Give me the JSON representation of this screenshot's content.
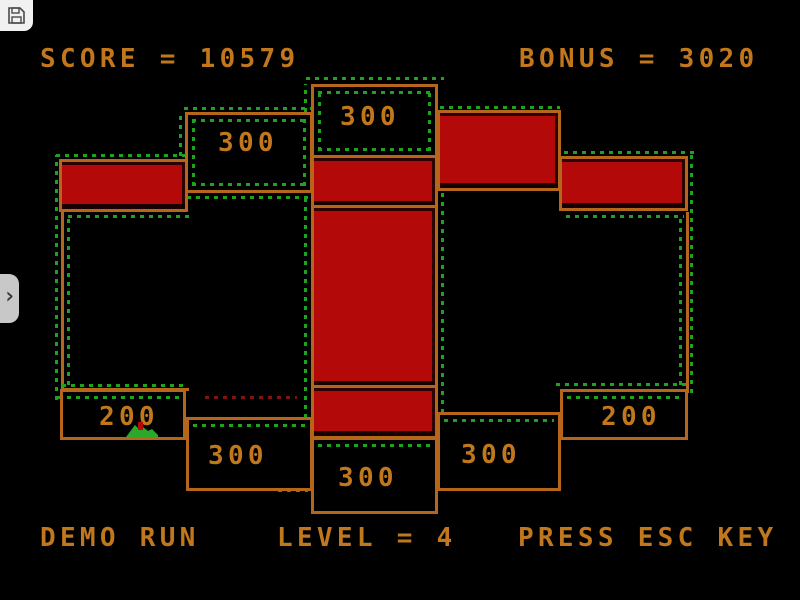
{
  "hud": {
    "score": "SCORE = 10579",
    "bonus": "BONUS = 3020"
  },
  "footer": {
    "demo": "DEMO RUN",
    "level": "LEVEL = 4",
    "esc_hint": "PRESS ESC KEY"
  },
  "board": {
    "labels": {
      "left_top": "300",
      "center_top": "300",
      "left_200": "200",
      "right_200": "200",
      "left_bottom": "300",
      "center_bottom": "300",
      "right_bottom": "300"
    }
  },
  "icons": {
    "save": "floppy-disk-icon",
    "drawer": "chevron-right-icon",
    "chevron_glyph": "›",
    "sprite": "green-creature-sprite"
  },
  "colors": {
    "bg": "#000000",
    "text_orange": "#c1771c",
    "line_orange": "#b5661a",
    "fill_red": "#b30909",
    "dot_green": "#1da31d",
    "dot_dark_red": "#801212",
    "chrome_gray": "#c8c8c8"
  }
}
